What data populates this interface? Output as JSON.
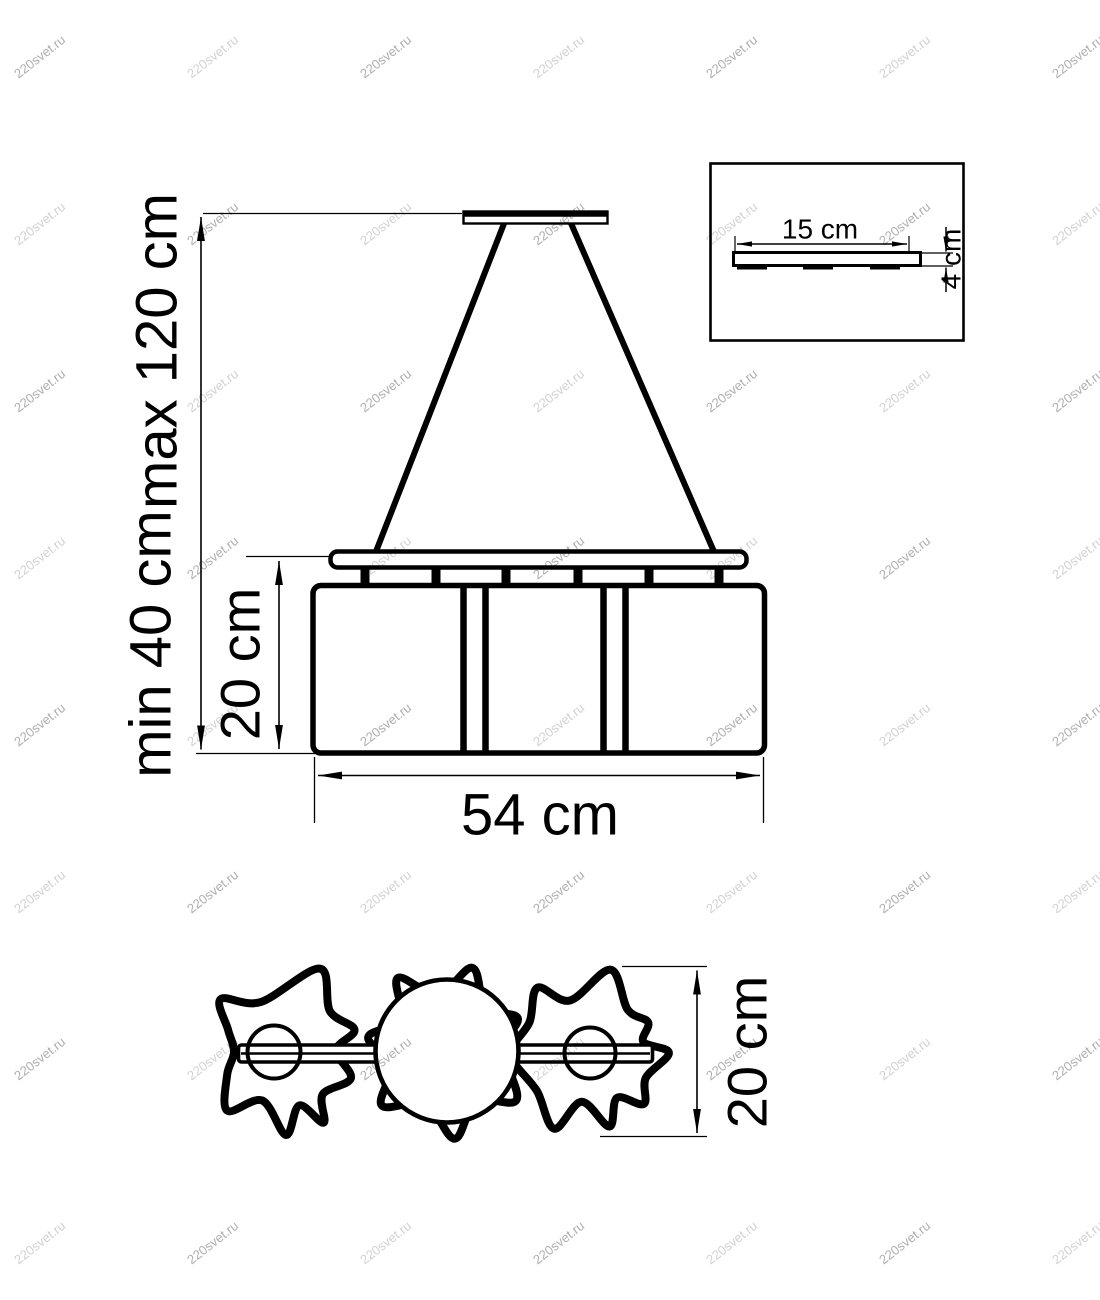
{
  "watermark": {
    "text": "220svet.ru",
    "color": "#9a9a9a"
  },
  "colors": {
    "line": "#000000",
    "background": "#ffffff",
    "dimension_text": "#000000"
  },
  "front_view": {
    "suspension_max_label": "max 120 cm",
    "suspension_min_label": "min 40 cm",
    "shade_height_label": "20 cm",
    "width_label": "54 cm"
  },
  "canopy_detail_inset": {
    "width_label": "15 cm",
    "height_label": "4 cm"
  },
  "plan_view": {
    "depth_label": "20 cm"
  }
}
